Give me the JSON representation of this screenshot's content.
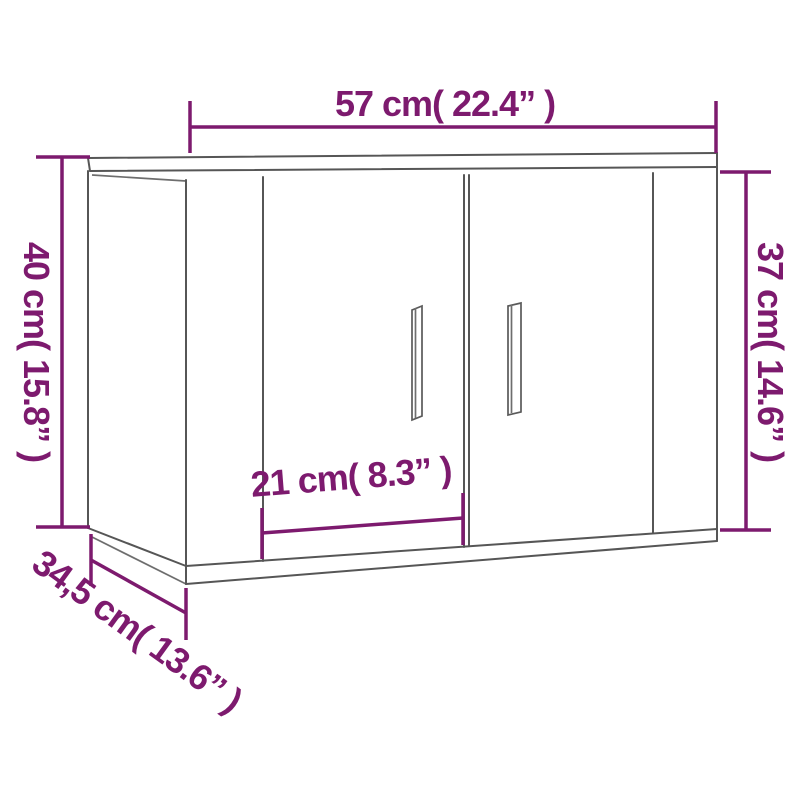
{
  "image": {
    "title": "Wall-mounted cabinet dimension diagram",
    "background_color": "#ffffff",
    "accent_color": "#7d1a6e",
    "outline_color": "#565656",
    "doors_count": 2,
    "handles_count": 2
  },
  "dimensions": {
    "width_top": {
      "label": "57 cm( 22.4” )",
      "cm": "57",
      "inches": "22.4"
    },
    "height_left": {
      "label": "40 cm( 15.8” )",
      "cm": "40",
      "inches": "15.8"
    },
    "height_right": {
      "label": "37 cm( 14.6” )",
      "cm": "37",
      "inches": "14.6"
    },
    "door_width": {
      "label": "21 cm( 8.3” )",
      "cm": "21",
      "inches": "8.3"
    },
    "depth_bottom": {
      "label": "34,5 cm( 13.6” )",
      "cm": "34,5",
      "inches": "13.6"
    }
  }
}
